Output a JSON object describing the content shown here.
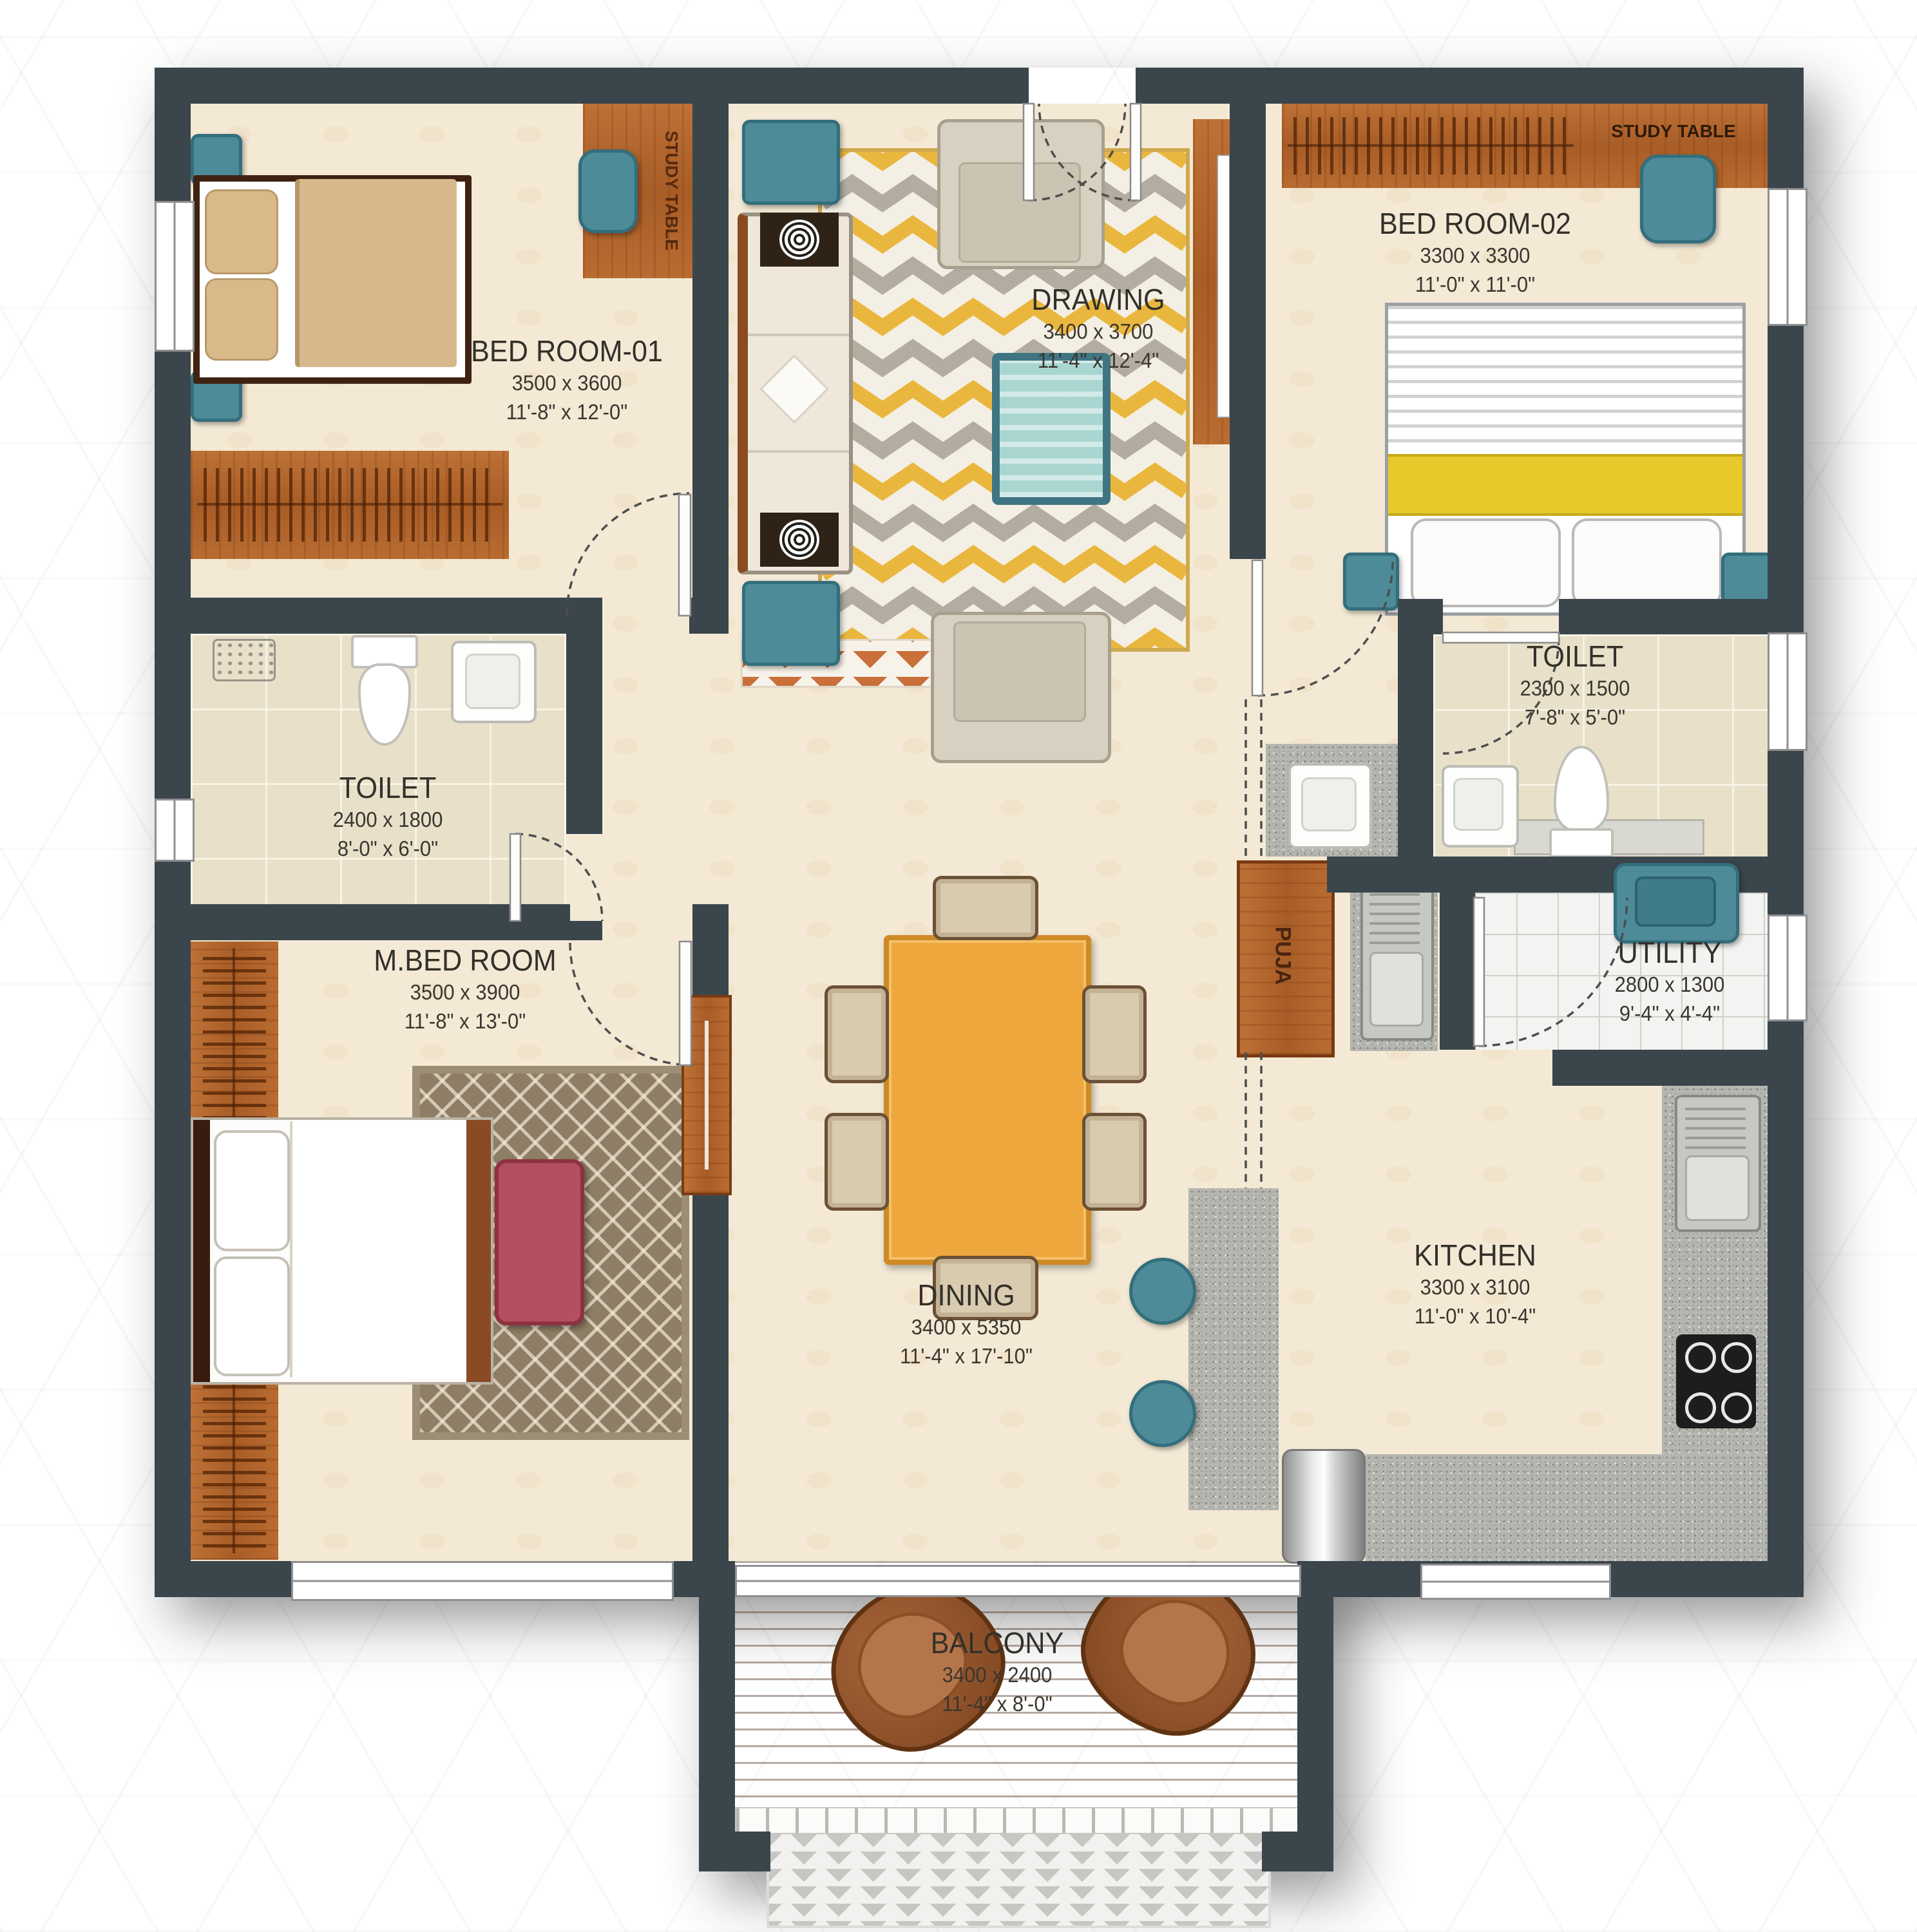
{
  "plan": {
    "rooms": [
      {
        "id": "bed_room_01",
        "name": "BED ROOM-01",
        "dim_mm": "3500 x 3600",
        "dim_ft": "11'-8\" x 12'-0\""
      },
      {
        "id": "drawing",
        "name": "DRAWING",
        "dim_mm": "3400 x 3700",
        "dim_ft": "11'-4\" x 12'-4\""
      },
      {
        "id": "bed_room_02",
        "name": "BED ROOM-02",
        "dim_mm": "3300 x 3300",
        "dim_ft": "11'-0\" x 11'-0\""
      },
      {
        "id": "toilet_1",
        "name": "TOILET",
        "dim_mm": "2400 x 1800",
        "dim_ft": "8'-0\" x 6'-0\""
      },
      {
        "id": "toilet_2",
        "name": "TOILET",
        "dim_mm": "2300 x 1500",
        "dim_ft": "7'-8\" x 5'-0\""
      },
      {
        "id": "m_bed_room",
        "name": "M.BED ROOM",
        "dim_mm": "3500 x 3900",
        "dim_ft": "11'-8\" x 13'-0\""
      },
      {
        "id": "dining",
        "name": "DINING",
        "dim_mm": "3400 x 5350",
        "dim_ft": "11'-4\" x 17'-10\""
      },
      {
        "id": "utility",
        "name": "UTILITY",
        "dim_mm": "2800 x 1300",
        "dim_ft": "9'-4\" x 4'-4\""
      },
      {
        "id": "kitchen",
        "name": "KITCHEN",
        "dim_mm": "3300 x 3100",
        "dim_ft": "11'-0\" x 10'-4\""
      },
      {
        "id": "balcony",
        "name": "BALCONY",
        "dim_mm": "3400 x 2400",
        "dim_ft": "11'-4\" x 8'-0\""
      },
      {
        "id": "puja",
        "name": "PUJA"
      }
    ],
    "furniture_labels": {
      "study_table_bedroom1": "STUDY TABLE",
      "study_table_bedroom2": "STUDY TABLE",
      "puja": "PUJA"
    },
    "colors": {
      "wall": "#3A454C",
      "floor": "#F4E9D5",
      "wood": "#B4682F",
      "teal": "#4E8B98",
      "dining_table": "#EDA73C",
      "rug_yellow": "#EAB73E",
      "rug_gray": "#B2ACA1",
      "deck_wood": "#A3714D",
      "granite": "#B6B6B0",
      "bench_red": "#B34F5E",
      "bed_yellow": "#E8C92C"
    }
  }
}
